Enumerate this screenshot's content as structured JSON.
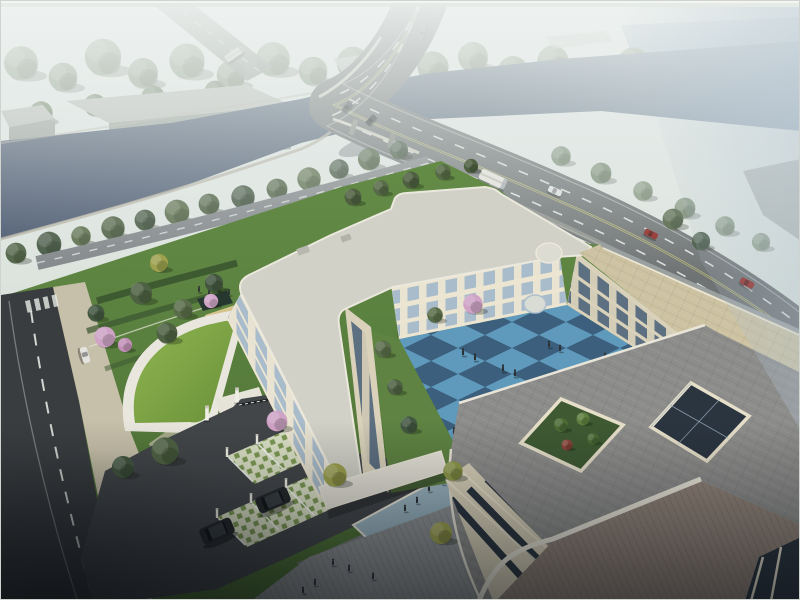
{
  "scene": {
    "label": "Aerial architectural rendering: three-story cream courtyard building with blue checkerboard plaza, green-roof gatehouse, parking and gardens beside a tree-lined river crossed by a curved highway bridge",
    "elements": [
      "hazy distant forest",
      "river canal",
      "curved highway bridge with traffic",
      "grey warehouse blocks",
      "tree-lined arterial road",
      "riverside access road",
      "city street with dashed lane lines",
      "landscaped garden with hedges",
      "curved green-roof gatehouse",
      "entrance gate and driveway",
      "grass-paver parking stalls with black SUVs",
      "U-shaped three-story cream building",
      "blue checkerboard courtyard with pedestrians",
      "grey paver rooftop with light well and planter",
      "pedestrian plaza",
      "rooftop terrace"
    ],
    "vehicles": {
      "buses": 2,
      "sedans": 7,
      "red_cars": 2,
      "white_van": 1,
      "parked_suvs": 2
    },
    "pedestrians_approx": 27
  },
  "palette": {
    "sky_top": "#edf1ee",
    "sky_bottom": "#c9d4ca",
    "fog_blue": "#aebfce",
    "water_far": "#9fb4c6",
    "forest_far": "#87987f",
    "forest_mid": "#667a58",
    "tree_a": "#4e6143",
    "tree_b": "#435640",
    "tree_c": "#5a6d4a",
    "tree_yellow": "#9da14e",
    "blossom": "#cfa3c6",
    "red_shrub": "#8a4438",
    "river": "#44526a",
    "river_light": "#5a6a7c",
    "embank": "#b6b2a3",
    "road": "#6f7374",
    "road_edge": "#a6a79e",
    "lane_white": "#eef0ea",
    "lane_yellow": "#c3c379",
    "bridge_edge": "#dcd9ca",
    "street": "#3a3d40",
    "drive": "#434649",
    "sidewalk": "#c6bfa9",
    "lawn": "#5e8342",
    "lawn_dark": "#4a6c33",
    "hedge": "#3a5530",
    "green_roof": "#7ca245",
    "sand": "#d4c38b",
    "panel_dark": "#263730",
    "lattice_bg": "#dce2c6",
    "lattice_green": "#7e9a54",
    "cream": "#ece5d1",
    "cream_shadow": "#d9d1b9",
    "roof_white": "#d1d1c7",
    "roof_gray": "#8d8d8b",
    "roof_tan": "#cdc3a2",
    "glass": "#a9bccb",
    "glass_shadow": "#5d7081",
    "glass_dark": "#2b3540",
    "court_light": "#5f9abc",
    "court_dark": "#3b5f7c",
    "walk_blue": "#9fb9c6",
    "plaza": "#8f9294",
    "terrace": "#92847a",
    "white_trim": "#ece8da",
    "suv": "#25282b",
    "car_red": "#8e2722",
    "van_white": "#e3e4e0",
    "people": "#2c3034"
  }
}
